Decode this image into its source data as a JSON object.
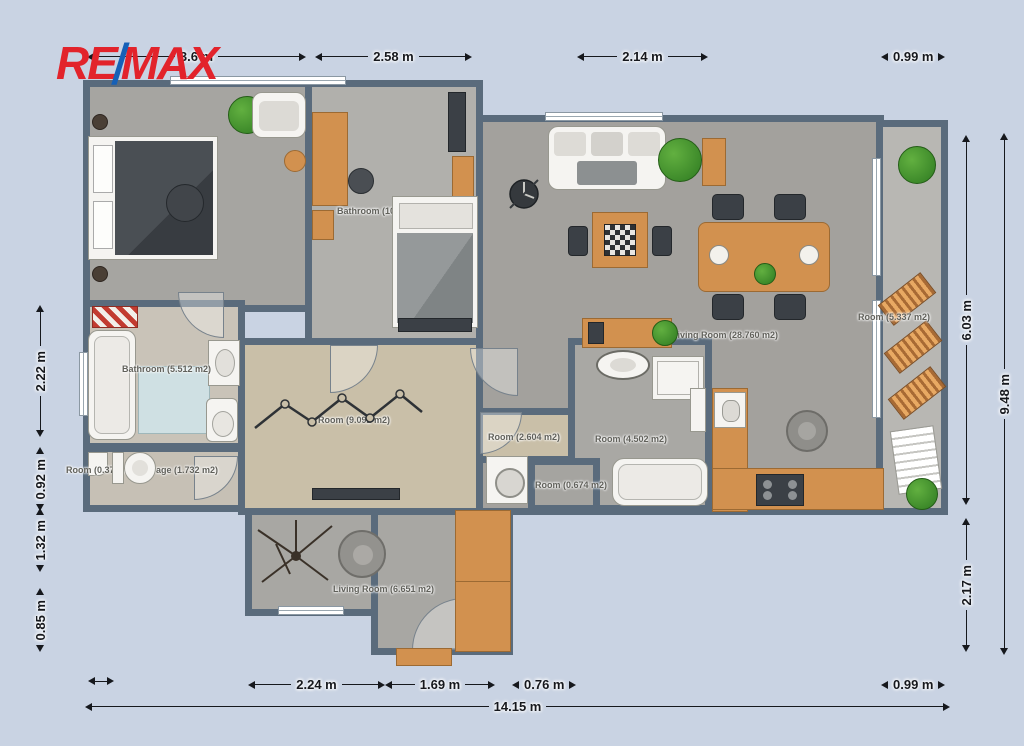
{
  "logo": {
    "part1": "RE",
    "slash": "/",
    "part2": "MAX"
  },
  "colors": {
    "brand_red": "#e2232b",
    "brand_blue": "#1660b7",
    "wall": "#5a6b7c",
    "background": "#c9d3e3",
    "furniture_accent": "#d2914f"
  },
  "dimensions": {
    "top": [
      {
        "label": "3.6 m"
      },
      {
        "label": "2.58 m"
      },
      {
        "label": "2.14 m"
      },
      {
        "label": "0.99 m"
      }
    ],
    "left": [
      {
        "label": "2.22 m"
      },
      {
        "label": "0.92 m"
      },
      {
        "label": "1.32 m"
      },
      {
        "label": "0.85 m"
      }
    ],
    "right": [
      {
        "label": "6.03 m"
      },
      {
        "label": "9.48 m"
      },
      {
        "label": "2.17 m"
      }
    ],
    "bottom": [
      {
        "label": "2.24 m"
      },
      {
        "label": "1.69 m"
      },
      {
        "label": "0.76 m"
      },
      {
        "label": "0.99 m"
      }
    ],
    "overall_width": {
      "label": "14.15 m"
    }
  },
  "rooms": [
    {
      "label": "Bathroom (10"
    },
    {
      "label": "Living Room (28.760 m2)"
    },
    {
      "label": "Room (5.337 m2)"
    },
    {
      "label": "Bathroom (5.512 m2)"
    },
    {
      "label": "Room (0.374 m2)"
    },
    {
      "label": "Storage (1.732 m2)"
    },
    {
      "label": "Room (9.092 m2)"
    },
    {
      "label": "Room (2.604 m2)"
    },
    {
      "label": "Room (4.502 m2)"
    },
    {
      "label": "Room (0.674 m2)"
    },
    {
      "label": "Living Room (6.651 m2)"
    }
  ]
}
